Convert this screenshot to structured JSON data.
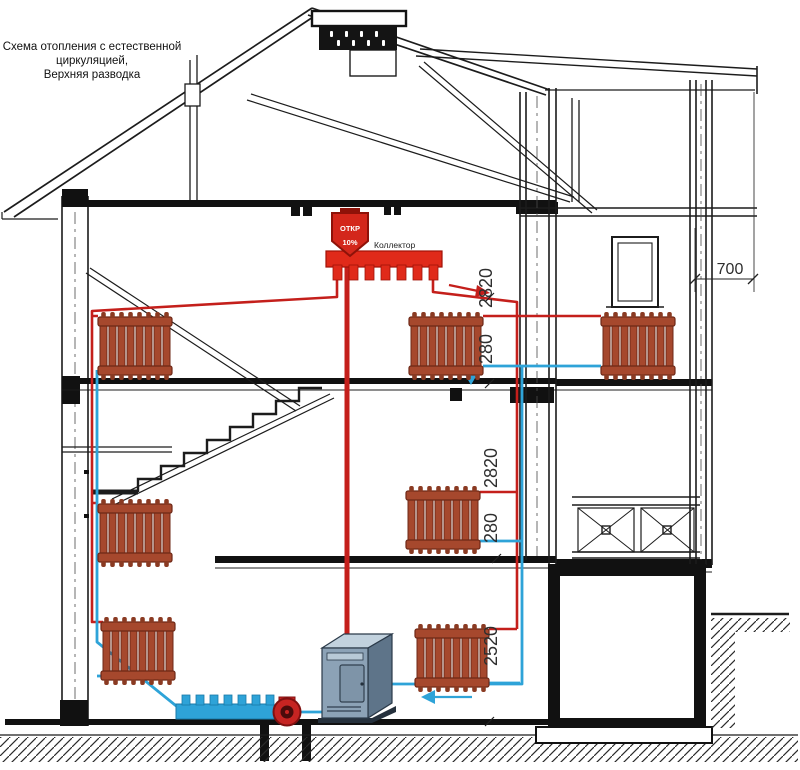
{
  "title": {
    "lines": [
      "Схема отопления с естественной",
      "циркуляцией,",
      "Верхняя разводка"
    ]
  },
  "labels": {
    "collector": "Коллектор",
    "expansion_tank_top": "ОТКР",
    "expansion_tank_bottom": "10%"
  },
  "dimensions": {
    "top_floor_height": "2820",
    "top_floor_pipe_drop": "280",
    "middle_floor_height": "2820",
    "middle_floor_pipe_drop": "280",
    "ground_floor_height": "2520",
    "roof_overhang": "700"
  },
  "colors": {
    "supply_pipe": "#C41F1B",
    "return_pipe": "#2EA3D8",
    "radiator_body": "#A6482D",
    "collector_red": "#E02A1A",
    "structure_line": "#1C1C1C",
    "background": "#FFFFFF"
  }
}
